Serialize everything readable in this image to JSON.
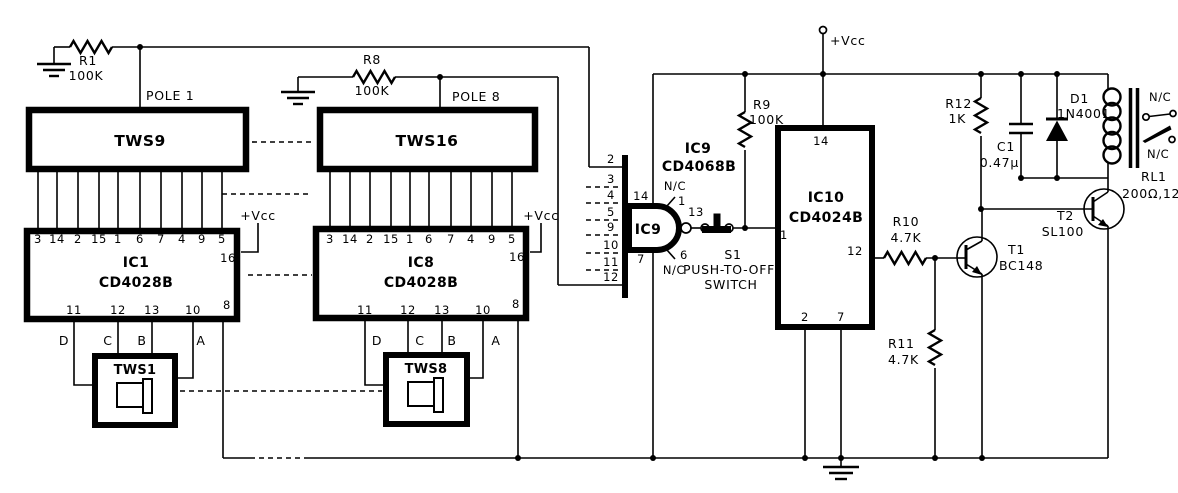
{
  "power": {
    "vcc_main": "+Vcc",
    "vcc_ic1": "+Vcc",
    "vcc_ic8": "+Vcc"
  },
  "switch_banks": {
    "tws9": {
      "label": "TWS9",
      "pole": "POLE 1"
    },
    "tws16": {
      "label": "TWS16",
      "pole": "POLE 8"
    },
    "tws1": {
      "label": "TWS1"
    },
    "tws8": {
      "label": "TWS8"
    }
  },
  "resistors": {
    "r1": {
      "ref": "R1",
      "value": "100K"
    },
    "r8": {
      "ref": "R8",
      "value": "100K"
    },
    "r9": {
      "ref": "R9",
      "value": "100K"
    },
    "r10": {
      "ref": "R10",
      "value": "4.7K"
    },
    "r11": {
      "ref": "R11",
      "value": "4.7K"
    },
    "r12": {
      "ref": "R12",
      "value": "1K"
    }
  },
  "ic1": {
    "ref": "IC1",
    "part": "CD4028B",
    "top_pins": [
      "3",
      "14",
      "2",
      "15",
      "1",
      "6",
      "7",
      "4",
      "9",
      "5"
    ],
    "pin_vcc": "16",
    "pin_out": "8",
    "bottom_pins": [
      "11",
      "12",
      "13",
      "10"
    ],
    "bcd": [
      "D",
      "C",
      "B",
      "A"
    ]
  },
  "ic8": {
    "ref": "IC8",
    "part": "CD4028B",
    "top_pins": [
      "3",
      "14",
      "2",
      "15",
      "1",
      "6",
      "7",
      "4",
      "9",
      "5"
    ],
    "pin_vcc": "16",
    "pin_out": "8",
    "bottom_pins": [
      "11",
      "12",
      "13",
      "10"
    ],
    "bcd": [
      "D",
      "C",
      "B",
      "A"
    ]
  },
  "ic9": {
    "ref": "IC9",
    "part": "CD4068B",
    "gate_label": "IC9",
    "input_pins": [
      "2",
      "3",
      "4",
      "5",
      "9",
      "10",
      "11",
      "12"
    ],
    "pin_vcc": "14",
    "pin_gnd": "7",
    "pin_nc_top": "1",
    "pin_nc_bottom": "6",
    "pin_out": "13",
    "nc_top": "N/C",
    "nc_bottom": "N/C"
  },
  "switch_s1": {
    "ref": "S1",
    "caption_line1": "PUSH-TO-OFF",
    "caption_line2": "SWITCH"
  },
  "ic10": {
    "ref": "IC10",
    "part": "CD4024B",
    "pin_vcc": "14",
    "pin_in": "1",
    "pin_out": "12",
    "pin_reset": "2",
    "pin_gnd": "7"
  },
  "transistors": {
    "t1": {
      "ref": "T1",
      "part": "BC148"
    },
    "t2": {
      "ref": "T2",
      "part": "SL100"
    }
  },
  "capacitors": {
    "c1": {
      "ref": "C1",
      "value": "0.47µ"
    }
  },
  "diodes": {
    "d1": {
      "ref": "D1",
      "part": "1N4001"
    }
  },
  "relay": {
    "ref": "RL1",
    "value": "200Ω,12V",
    "contact_top": "N/C",
    "contact_bottom": "N/C"
  }
}
